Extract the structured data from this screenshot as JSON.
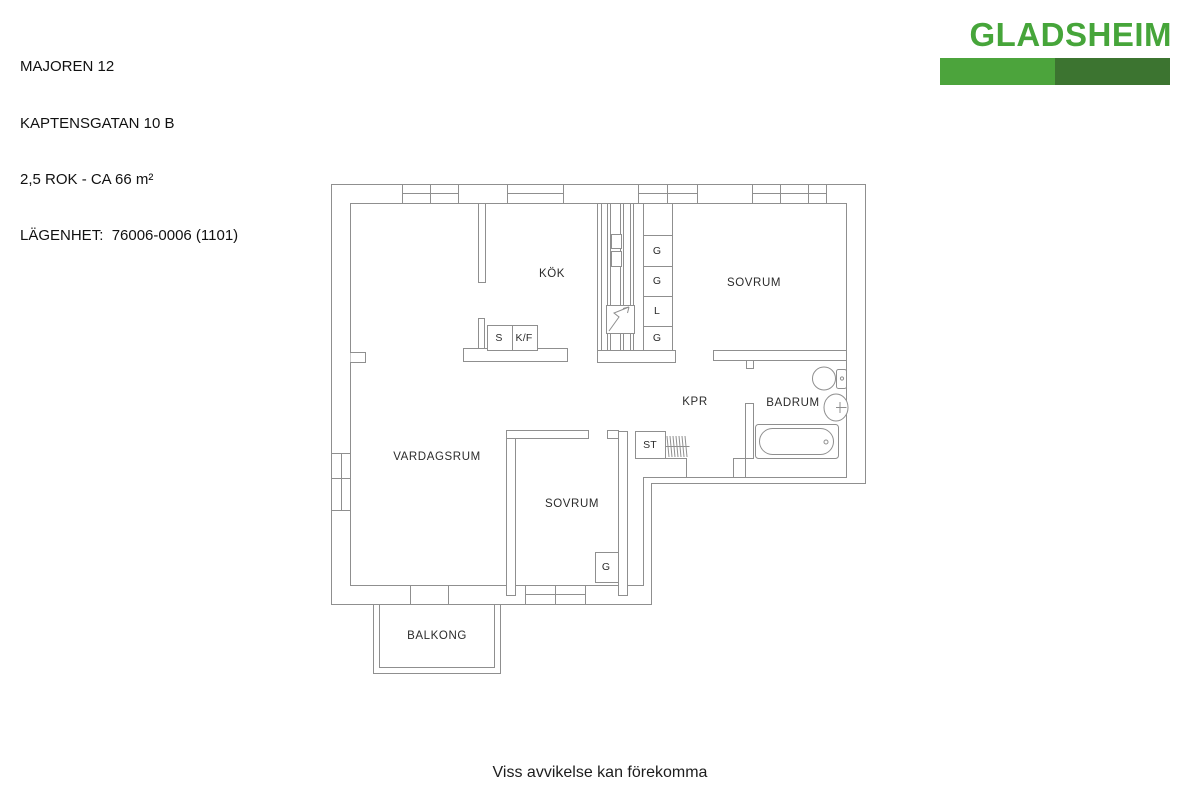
{
  "header": {
    "project": "MAJOREN 12",
    "address": "KAPTENSGATAN 10 B",
    "size": "2,5 ROK - CA 66 m²",
    "apartment": "LÄGENHET:  76006-0006 (1101)"
  },
  "logo": {
    "text": "GLADSHEIM",
    "text_color": "#46a53a",
    "bar_left_color": "#4ca43c",
    "bar_right_color": "#3c7430",
    "bar_left_style": "background:#4ca43c",
    "bar_right_style": "background:#3c7430"
  },
  "floorplan": {
    "rooms": {
      "kok": "KÖK",
      "sovrum1": "SOVRUM",
      "vardagsrum": "VARDAGSRUM",
      "sovrum2": "SOVRUM",
      "kpr": "KPR",
      "badrum": "BADRUM",
      "balkong": "BALKONG"
    },
    "storage": {
      "st": "ST",
      "g1": "G",
      "g2": "G",
      "l": "L",
      "g3": "G",
      "g4": "G"
    },
    "appliances": {
      "stove": "S",
      "fridge_freezer": "K/F"
    },
    "wall_color": "#8f8f8f"
  },
  "footer": {
    "disclaimer": "Viss avvikelse kan förekomma"
  }
}
